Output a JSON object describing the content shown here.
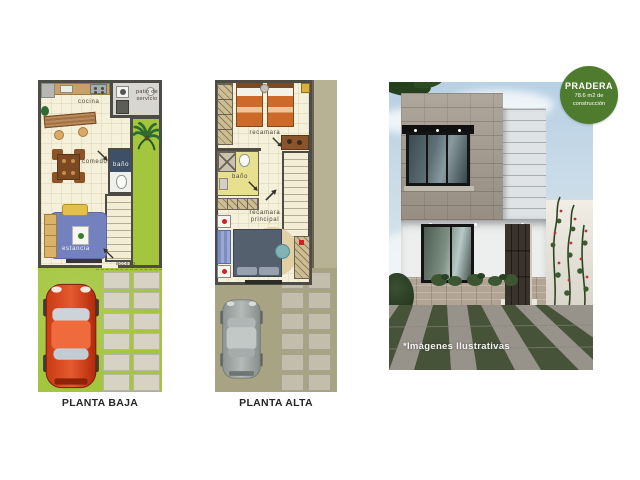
{
  "floorplans": {
    "planta_baja": {
      "caption": "PLANTA BAJA",
      "rooms": {
        "cocina": "cocina",
        "patio_de_servicio": "patio de servicio",
        "comedor": "comedor",
        "bano": "baño",
        "estancia": "estancia",
        "acceso": "acceso"
      }
    },
    "planta_alta": {
      "caption": "PLANTA ALTA",
      "rooms": {
        "recamara": "recamara",
        "bano": "baño",
        "recamara_principal": "recamara principal"
      }
    }
  },
  "render": {
    "badge": {
      "title": "PRADERA",
      "area_line1": "78.6 m2 de",
      "area_line2": "construcción",
      "background": "#4e7b2d"
    },
    "disclaimer": "*Imágenes Ilustrativas"
  },
  "colors": {
    "plan_wall": "#4d4b45",
    "plan_floor": "#f5f0da",
    "grass": "#a4c63f",
    "grass_faded": "#a7a383",
    "paver": "#d6d2c4",
    "badge_green": "#4e7b2d",
    "driveway_grass": "#475339",
    "driveway_stone": "#97938a"
  }
}
